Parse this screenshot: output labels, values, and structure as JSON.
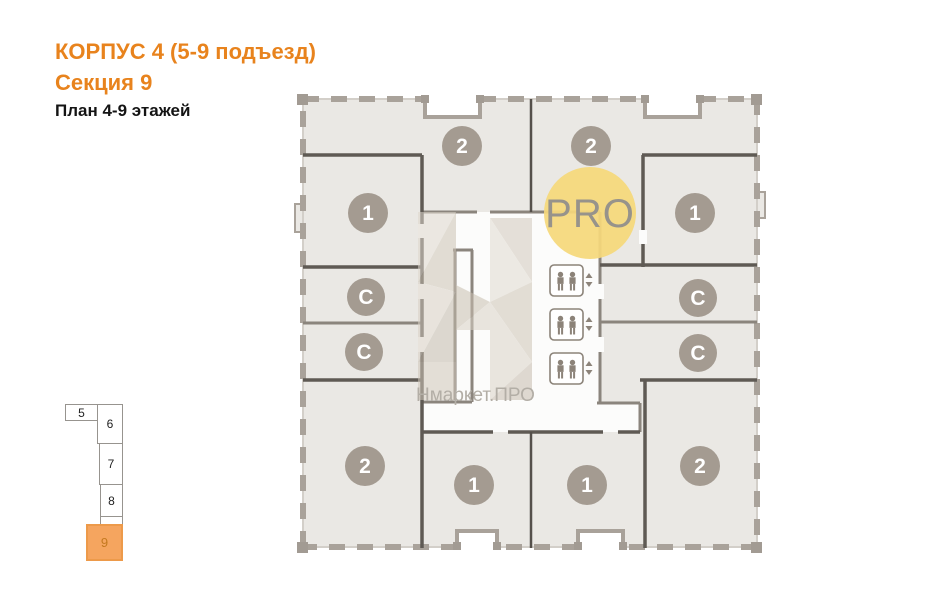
{
  "header": {
    "building_title": "КОРПУС 4 (5-9 подъезд)",
    "section_title": "Секция 9",
    "plan_subtitle": "План 4-9 этажей"
  },
  "plan": {
    "units": [
      {
        "label": "2",
        "position": "top-left"
      },
      {
        "label": "2",
        "position": "top-right"
      },
      {
        "label": "1",
        "position": "upper-left"
      },
      {
        "label": "1",
        "position": "upper-right"
      },
      {
        "label": "С",
        "position": "mid-left-upper"
      },
      {
        "label": "С",
        "position": "mid-right-upper"
      },
      {
        "label": "С",
        "position": "mid-left-lower"
      },
      {
        "label": "С",
        "position": "mid-right-lower"
      },
      {
        "label": "2",
        "position": "bottom-left"
      },
      {
        "label": "1",
        "position": "bottom-center-left"
      },
      {
        "label": "1",
        "position": "bottom-center-right"
      },
      {
        "label": "2",
        "position": "bottom-right"
      }
    ],
    "elevators": {
      "count": 3,
      "icon": "two-person-elevator-icon",
      "up_arrow": "▲",
      "down_arrow": "▼"
    }
  },
  "branding": {
    "logo_text": "PRO",
    "watermark_text": "Нмаркет.ПРО"
  },
  "minimap": {
    "sections": [
      {
        "label": "5",
        "active": false
      },
      {
        "label": "6",
        "active": false
      },
      {
        "label": "7",
        "active": false
      },
      {
        "label": "8",
        "active": false
      },
      {
        "label": "9",
        "active": true
      }
    ]
  },
  "colors": {
    "accent_orange": "#E8831D",
    "pro_circle_yellow": "#F5D87B",
    "unit_circle_gray": "#A49B91",
    "active_section_fill": "#F5A55F",
    "active_section_border": "#ED9A4A",
    "active_section_text": "#C4791F"
  }
}
